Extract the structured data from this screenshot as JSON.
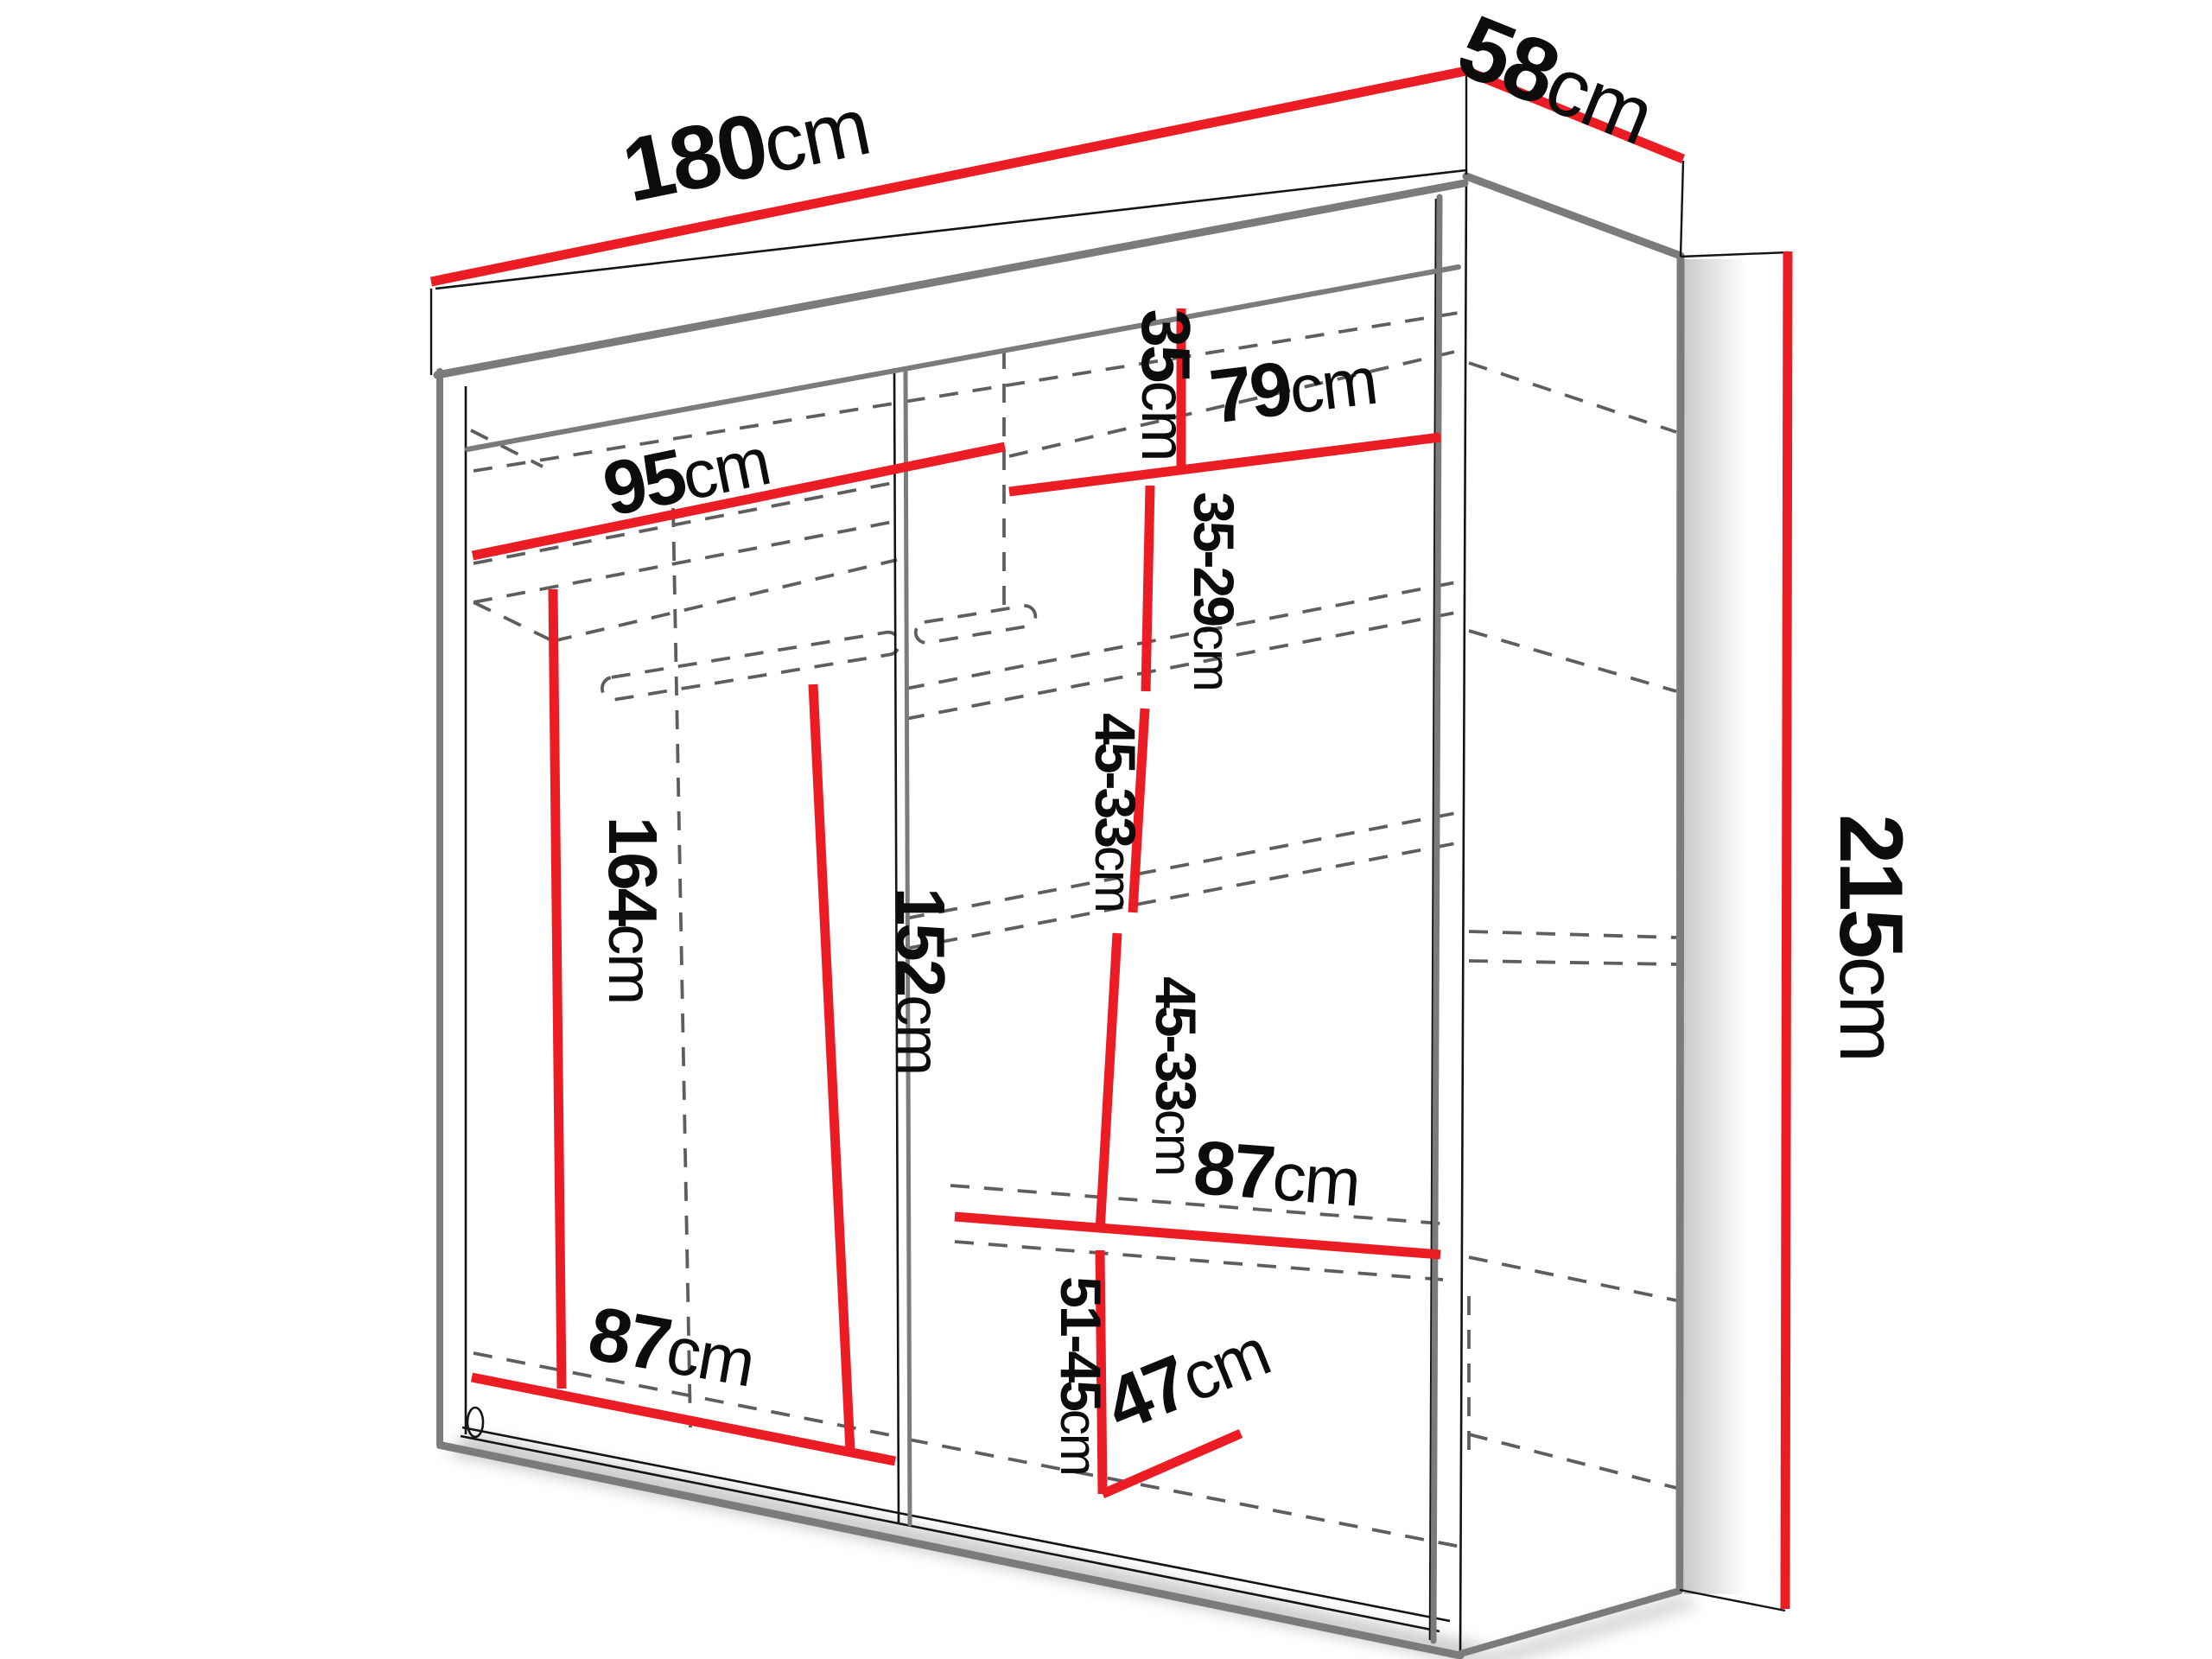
{
  "diagram": {
    "type": "wardrobe-dimension-drawing",
    "unit_default": "cm",
    "colors": {
      "dimension_line": "#EC1C24",
      "outline": "#141414",
      "panel_gray": "#7b7b7b",
      "hidden_line": "#5e5e5e",
      "background": "#ffffff"
    },
    "dimensions": {
      "total_width": {
        "value": "180",
        "unit": "cm"
      },
      "total_depth": {
        "value": "58",
        "unit": "cm"
      },
      "total_height": {
        "value": "215",
        "unit": "cm"
      },
      "left_top_inner_width": {
        "value": "95",
        "unit": "cm"
      },
      "right_top_shelf_width": {
        "value": "79",
        "unit": "cm"
      },
      "right_top_shelf_height": {
        "value": "35",
        "unit": "cm"
      },
      "right_gap_upper": {
        "value": "35-29",
        "unit": "cm"
      },
      "right_gap_middle": {
        "value": "45-33",
        "unit": "cm"
      },
      "right_gap_lower": {
        "value": "45-33",
        "unit": "cm"
      },
      "right_bottom_width": {
        "value": "87",
        "unit": "cm"
      },
      "right_bottom_height": {
        "value": "51-45",
        "unit": "cm"
      },
      "right_bottom_depth": {
        "value": "47",
        "unit": "cm"
      },
      "left_bottom_width": {
        "value": "87",
        "unit": "cm"
      },
      "left_hanging_height_1": {
        "value": "164",
        "unit": "cm"
      },
      "left_hanging_height_2": {
        "value": "152",
        "unit": "cm"
      }
    }
  }
}
